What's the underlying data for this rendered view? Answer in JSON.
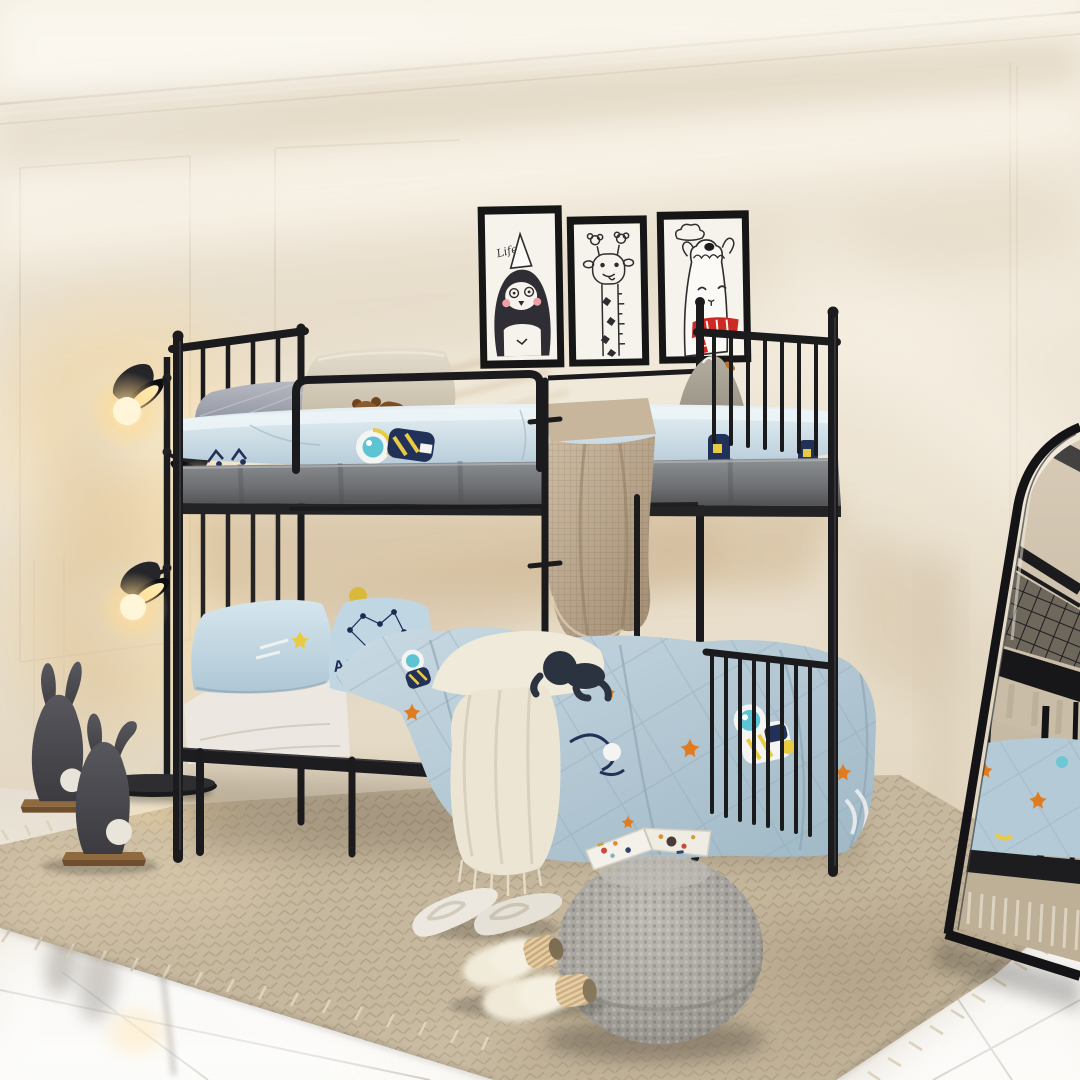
{
  "scene": {
    "description": "Kids bedroom product photo: black metal twin bunk bed with space-print blue bedding on a textured beige rug over glossy white tile, cream panelled wall with warm diagonal window light",
    "texts": {
      "penguin_frame_caption": "Life",
      "space_pillow_visible_letters": "ACE"
    },
    "wall_art": [
      {
        "name": "penguin-print",
        "subject": "cartoon penguin in white party hat",
        "caption": "Life",
        "frame_color": "#161616"
      },
      {
        "name": "giraffe-print",
        "subject": "cartoon giraffe growth chart with flower horns",
        "frame_color": "#161616"
      },
      {
        "name": "llama-print",
        "subject": "cartoon llama with red striped scarf under a cloud",
        "frame_color": "#161616"
      }
    ],
    "objects": [
      {
        "name": "bunk-bed",
        "type": "twin-over-twin metal bunk bed",
        "color": "#1b1b1d"
      },
      {
        "name": "top-bunk-bedding",
        "items": [
          "grey quilted pillow",
          "beige pillow",
          "brown teddy bear",
          "blue astronaut fitted sheet",
          "grey plush toy",
          "taupe waffle knit throw"
        ]
      },
      {
        "name": "bottom-bunk-bedding",
        "items": [
          "blue shooting-star pillow",
          "blue SPACE constellation pillow",
          "white sheet",
          "cream chunky knit throw with fringe",
          "navy plush toy",
          "light blue astronaut comforter with orange stars"
        ]
      },
      {
        "name": "floor-lamp",
        "type": "black three-head spotlight floor lamp",
        "state": "on",
        "glow_color": "#ffd98f"
      },
      {
        "name": "felt-rabbits",
        "count": 2,
        "color": "#4a4a4f",
        "detail": "white pompom tails, wooden bases"
      },
      {
        "name": "area-rug",
        "color": "#c6b89e",
        "detail": "herringbone texture with fringe"
      },
      {
        "name": "knitted-pouf",
        "color": "#a5a29d"
      },
      {
        "name": "picture-book",
        "detail": "open picture book on pouf"
      },
      {
        "name": "flip-flop-slippers",
        "color": "#ece8df"
      },
      {
        "name": "fuzzy-slippers",
        "color": "#f0ead9",
        "detail": "tan ribbed cuff"
      },
      {
        "name": "arched-floor-mirror",
        "frame_color": "#141416",
        "detail": "reflects bunk bed and rug"
      },
      {
        "name": "tile-floor",
        "color": "#f3f1ed",
        "detail": "glossy white tiles with reflections"
      }
    ],
    "palette": {
      "wall": "#eee7da",
      "wall_shadow": "#cdb491",
      "streak_light": "#faf6ec",
      "bed_black": "#1b1b1d",
      "rail_gray": "#77797c",
      "sheet_blue": "#cfe2eb",
      "comforter_blue": "#b7cdd9",
      "print_navy": "#223158",
      "print_teal": "#5ec4d4",
      "print_yellow": "#e9cb43",
      "print_orange": "#e07b1f",
      "pillow_gray": "#9196a1",
      "pillow_beige": "#d9d2c2",
      "pillow_blue": "#c6dbe6",
      "throw_taupe": "#c0ae95",
      "throw_cream": "#efeada",
      "rug": "#c6b89e",
      "tile": "#f3f1ed",
      "pouf": "#a5a29d",
      "lamp_glow": "#ffd98f",
      "felt_gray": "#4a4a4f",
      "wood": "#8f6a3e",
      "scarf_red": "#cc2a23"
    }
  }
}
